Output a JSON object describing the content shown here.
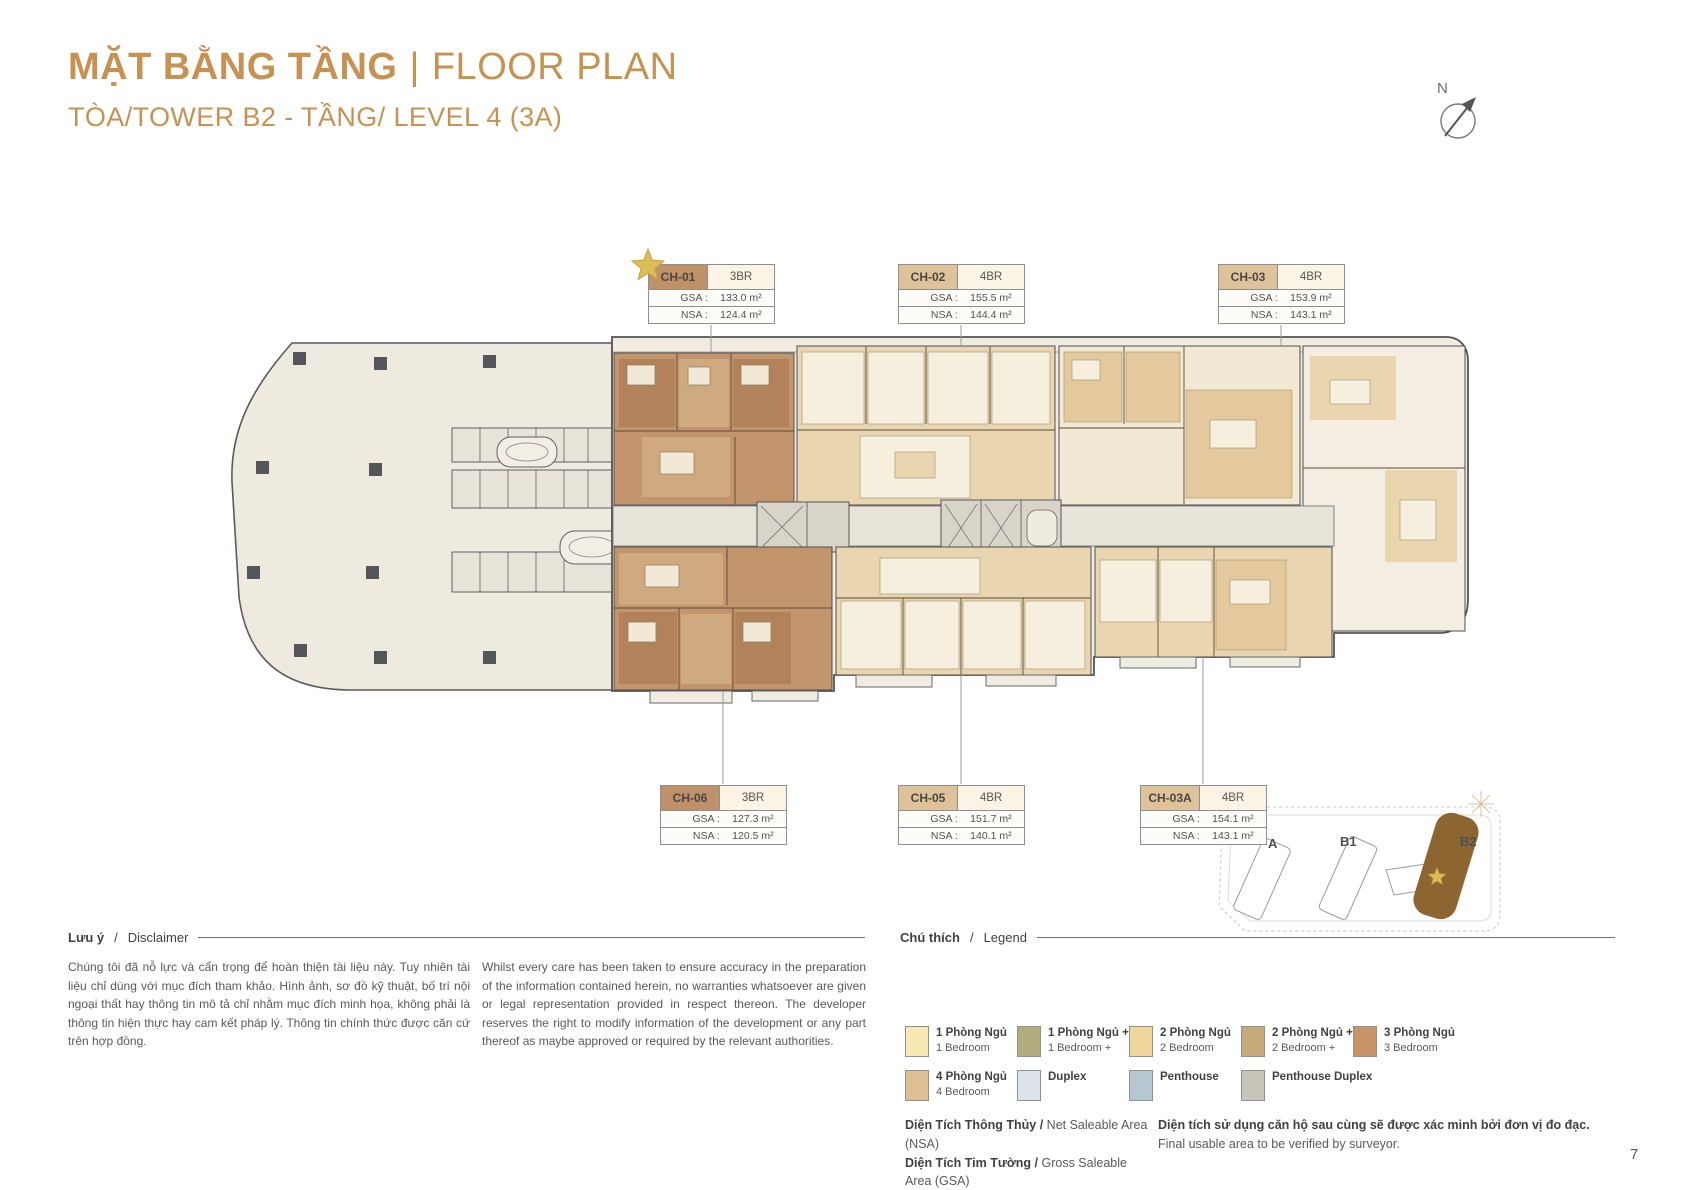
{
  "colors": {
    "accent": "#C59253",
    "unit_3br": "#BE9169",
    "unit_4br": "#DEC29A",
    "tower_b2_fill": "#8D6530",
    "star_gold": "#DCBC56"
  },
  "header": {
    "title_vi": "MẶT BẰNG TẦNG",
    "separator": "|",
    "title_en": "FLOOR PLAN",
    "subtitle": "TÒA/TOWER B2 - TẦNG/ LEVEL 4 (3A)"
  },
  "compass": {
    "north": "N"
  },
  "area_labels": {
    "gsa": "GSA :",
    "nsa": "NSA :"
  },
  "units": [
    {
      "id": "CH-01",
      "type": "3BR",
      "gsa": "133.0 m²",
      "nsa": "124.4 m²",
      "color": "#BE9169",
      "starred": true
    },
    {
      "id": "CH-02",
      "type": "4BR",
      "gsa": "155.5 m²",
      "nsa": "144.4 m²",
      "color": "#DEC29A",
      "starred": false
    },
    {
      "id": "CH-03",
      "type": "4BR",
      "gsa": "153.9 m²",
      "nsa": "143.1 m²",
      "color": "#DEC29A",
      "starred": false
    },
    {
      "id": "CH-06",
      "type": "3BR",
      "gsa": "127.3 m²",
      "nsa": "120.5 m²",
      "color": "#BE9169",
      "starred": false
    },
    {
      "id": "CH-05",
      "type": "4BR",
      "gsa": "151.7 m²",
      "nsa": "140.1 m²",
      "color": "#DEC29A",
      "starred": false
    },
    {
      "id": "CH-03A",
      "type": "4BR",
      "gsa": "154.1 m²",
      "nsa": "143.1 m²",
      "color": "#DEC29A",
      "starred": false
    }
  ],
  "disclaimer": {
    "heading_vi": "Lưu ý",
    "heading_sep": "/",
    "heading_en": "Disclaimer",
    "body_vi": "Chúng tôi đã nỗ lực và cẩn trọng để hoàn thiện tài liệu này. Tuy nhiên tài liệu chỉ dùng với mục đích tham khảo. Hình ảnh, sơ đồ kỹ thuật, bố trí nội ngoại thất hay thông tin mô tả chỉ nhằm mục đích minh họa, không phải là thông tin hiện thực hay cam kết pháp lý. Thông tin chính thức được căn cứ trên hợp đồng.",
    "body_en": "Whilst every care has been taken to ensure accuracy in the preparation of the information contained herein, no warranties whatsoever are given or legal representation provided in respect thereon. The developer reserves the right to modify information of the development or any part thereof as maybe approved or required by the relevant authorities."
  },
  "legend": {
    "heading_vi": "Chú thích",
    "heading_sep": "/",
    "heading_en": "Legend",
    "items": [
      {
        "vi": "1 Phòng Ngủ",
        "en": "1 Bedroom",
        "color": "#F8E9B4"
      },
      {
        "vi": "1 Phòng Ngủ +",
        "en": "1 Bedroom +",
        "color": "#B2AB7D"
      },
      {
        "vi": "2 Phòng Ngủ",
        "en": "2 Bedroom",
        "color": "#F0D79E"
      },
      {
        "vi": "2 Phòng Ngủ +",
        "en": "2 Bedroom +",
        "color": "#C7AA7C"
      },
      {
        "vi": "3 Phòng Ngủ",
        "en": "3 Bedroom",
        "color": "#C79367"
      },
      {
        "vi": "4 Phòng Ngủ",
        "en": "4 Bedroom",
        "color": "#DEBE95"
      },
      {
        "vi": "Duplex",
        "en": "",
        "color": "#DBE4E8"
      },
      {
        "vi": "Penthouse",
        "en": "",
        "color": "#B5C7D1"
      },
      {
        "vi": "Penthouse Duplex",
        "en": "",
        "color": "#C8C5BA"
      }
    ],
    "nsa_vi": "Diện Tích Thông Thủy /",
    "nsa_en": "Net Saleable Area (NSA)",
    "gsa_vi": "Diện Tích Tim Tường /",
    "gsa_en": "Gross Saleable Area (GSA)",
    "note_vi": "Diện tích sử dụng căn hộ sau cùng sẽ được xác minh bởi đơn vị đo đạc.",
    "note_en": "Final usable area to be verified by surveyor."
  },
  "site_map": {
    "tower_a": "A",
    "tower_b1": "B1",
    "tower_b2": "B2"
  },
  "page_number": "7"
}
